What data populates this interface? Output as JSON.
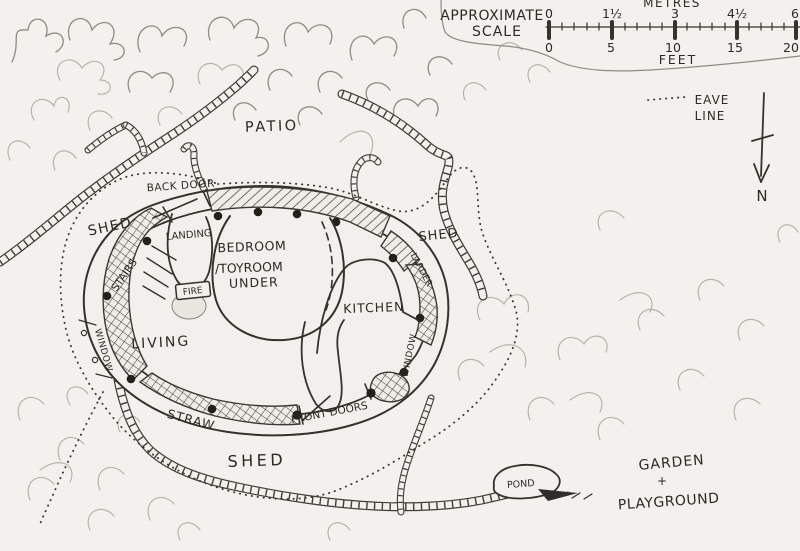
{
  "title": "Hand-drawn cob house site plan sketch",
  "colors": {
    "ink": "#2f2d29",
    "pencil_light": "#b9b3ab",
    "pencil_dark": "#918b83",
    "paper": "#f3f1ed"
  },
  "scale": {
    "heading_line1": "APPROXIMATE",
    "heading_line2": "SCALE",
    "metres_label": "METRES",
    "feet_label": "FEET",
    "metres_ticks": [
      "0",
      "1½",
      "3",
      "4½",
      "6"
    ],
    "feet_ticks": [
      "0",
      "5",
      "10",
      "15",
      "20"
    ]
  },
  "legend": {
    "eave_line1": "EAVE",
    "eave_line2": "LINE",
    "north": "N"
  },
  "labels": {
    "patio": "PATIO",
    "back_door": "BACK DOOR",
    "shed_left": "SHED",
    "shed_right": "SHED",
    "shed_bottom": "SHED",
    "landing": "LANDING",
    "bedroom_line1": "BEDROOM",
    "bedroom_line2": "/TOYROOM",
    "bedroom_line3": "UNDER",
    "fire": "FIRE",
    "stairs": "STAIRS",
    "kitchen": "KITCHEN",
    "living": "LIVING",
    "window_left": "WINDOW",
    "window_right": "WINDOW",
    "larder": "LARDER",
    "straw": "STRAW",
    "front_doors": "FRONT DOORS",
    "pond": "POND",
    "garden_line1": "GARDEN",
    "garden_line2": "+",
    "garden_line3": "PLAYGROUND"
  }
}
